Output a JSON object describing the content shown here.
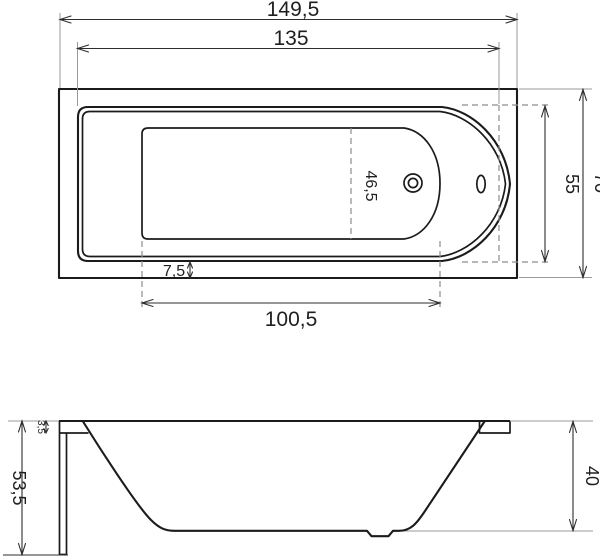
{
  "drawing": {
    "title": "bathtub-dimension-drawing",
    "colors": {
      "background": "#ffffff",
      "outline": "#1b1b1b",
      "dimension_line": "#2e2e2e",
      "extension_line": "#9a9a9a",
      "hidden_edge_dash": "#8c8c8c"
    },
    "views": {
      "top": {
        "dimensions": {
          "overall_length": "149,5",
          "rim_length": "135",
          "overall_width": "70",
          "opening_width": "55",
          "floor_width": "46,5",
          "rim_to_edge_offset": "7,5",
          "floor_length": "100,5"
        }
      },
      "side": {
        "dimensions": {
          "overall_height": "53,5",
          "rim_lip_thickness": "3,5",
          "inner_depth": "40"
        }
      }
    }
  }
}
